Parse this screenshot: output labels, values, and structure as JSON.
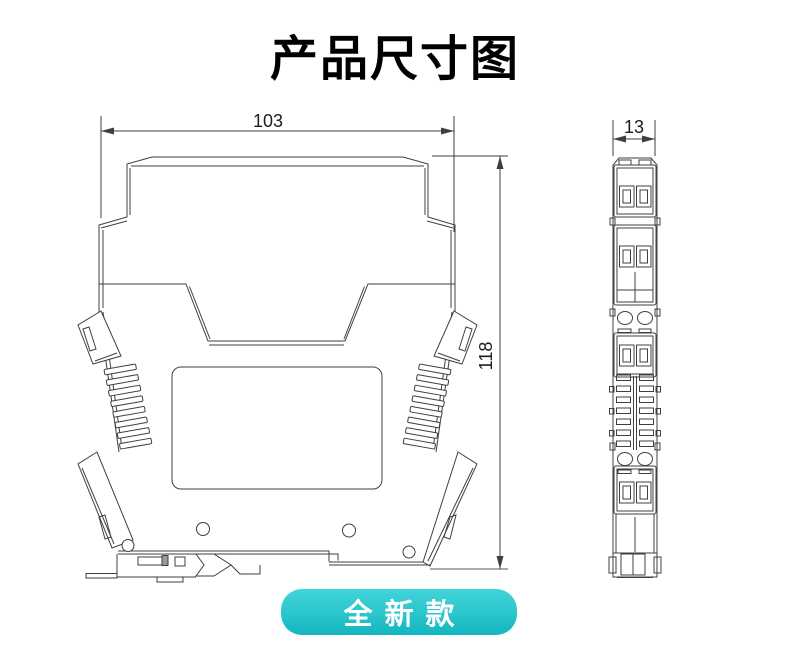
{
  "page": {
    "title": "产品尺寸图"
  },
  "drawing": {
    "dimensions": {
      "overall_width": "103",
      "overall_height": "118",
      "overall_depth": "13"
    }
  },
  "badge": {
    "label": "全新款"
  },
  "colors": {
    "badge_gradient_top": "#41d4da",
    "badge_gradient_bottom": "#13b6bf",
    "badge_text": "#ffffff",
    "drawing_line": "#3f3f3f",
    "background": "#ffffff"
  }
}
